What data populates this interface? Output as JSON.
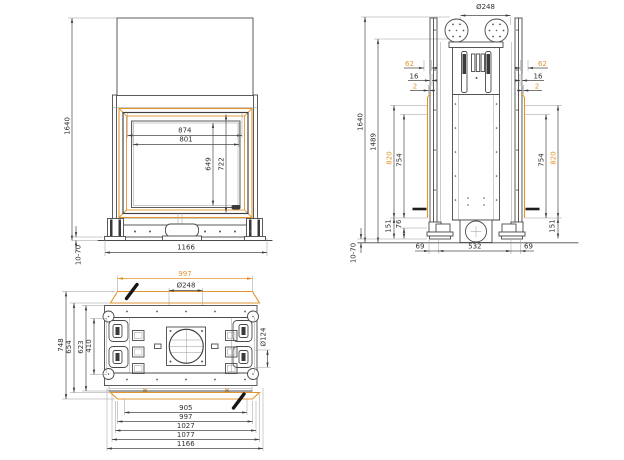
{
  "colors": {
    "accent_orange": "#E2952F",
    "drawing_line": "#4A4A4A",
    "marker_black": "#161616"
  },
  "views": {
    "front": {
      "dims": {
        "overall_height": "1640",
        "frame_width_outer": "874",
        "frame_width_inner": "801",
        "glass_height": "649",
        "door_height": "722",
        "overall_width": "1166",
        "leveling_feet_range": "10-70"
      }
    },
    "side": {
      "dims": {
        "flue_diameter": "Ø248",
        "overall_height": "1640",
        "body_height": "1489",
        "top_offset": "62",
        "panel_offset": "16",
        "edge_offset": "2",
        "frame_height": "820",
        "glass_height": "754",
        "base_height": "151",
        "foot_zone_height": "76",
        "side_inset": "69",
        "base_depth": "532",
        "leveling_feet_range": "10-70"
      }
    },
    "plan": {
      "dims": {
        "frame_width": "997",
        "flue_diameter": "Ø248",
        "corner_diameter": "Ø124",
        "overall_depth": "748",
        "body_depth": "654",
        "inner_depth": "623",
        "bracket_span": "410",
        "width_905": "905",
        "width_997": "997",
        "width_1027": "1027",
        "width_1077": "1077",
        "width_1166": "1166"
      }
    }
  }
}
